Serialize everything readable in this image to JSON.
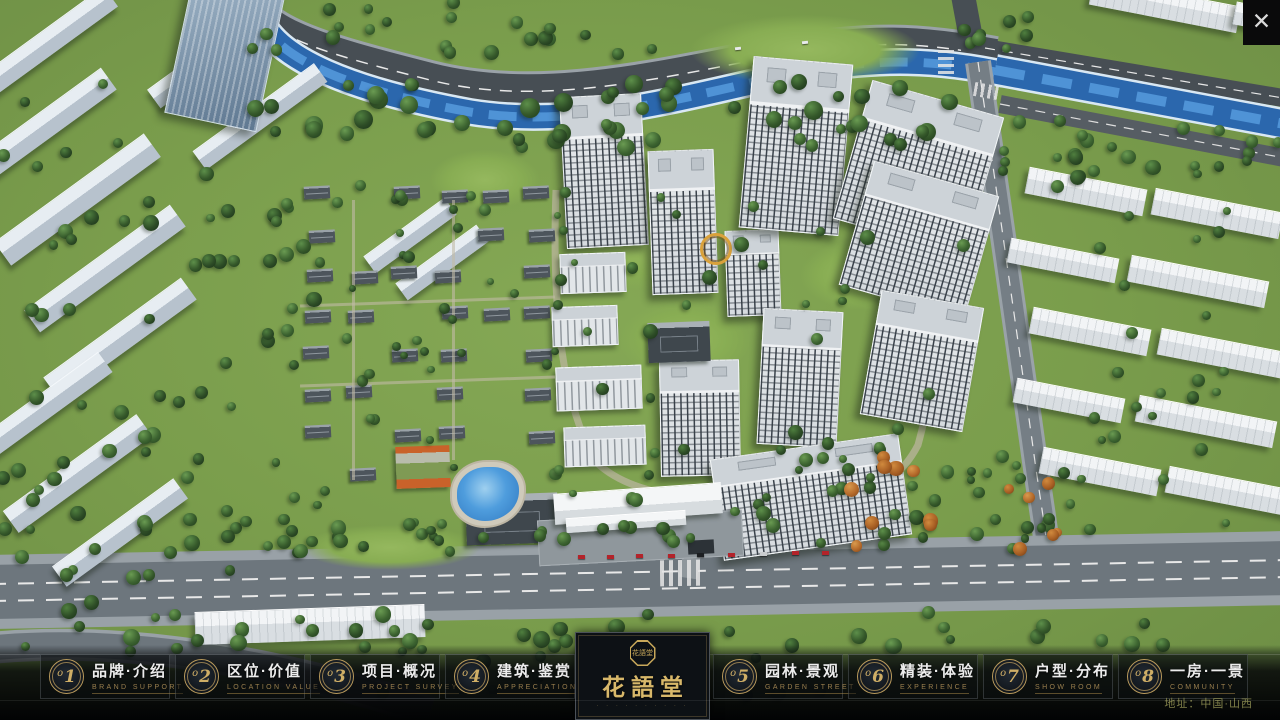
{
  "chrome": {
    "close_icon": "✕"
  },
  "menu": {
    "items": [
      {
        "badge": "o1",
        "zh": "品牌·介绍",
        "en": "BRAND SUPPORT"
      },
      {
        "badge": "o2",
        "zh": "区位·价值",
        "en": "LOCATION VALUE"
      },
      {
        "badge": "o3",
        "zh": "项目·概况",
        "en": "PROJECT SURVEY"
      },
      {
        "badge": "o4",
        "zh": "建筑·鉴赏",
        "en": "APPRECIATION"
      },
      {
        "badge": "o5",
        "zh": "园林·景观",
        "en": "GARDEN STREET"
      },
      {
        "badge": "o6",
        "zh": "精装·体验",
        "en": "EXPERIENCE"
      },
      {
        "badge": "o7",
        "zh": "户型·分布",
        "en": "SHOW ROOM"
      },
      {
        "badge": "o8",
        "zh": "一房·一景",
        "en": "COMMUNITY"
      }
    ]
  },
  "logo": {
    "name": "花語堂",
    "seal_text": "花語堂",
    "subtext": "· · · · · · · · · ·"
  },
  "footer": {
    "address": "地址：中国·山西"
  },
  "colors": {
    "gold": "#c8a85a",
    "badge_gold": "#b99a5c",
    "menu_text": "#ececec",
    "menu_caption": "#9a7f4e",
    "address_text": "#8f8f52",
    "bar_bg": "#060709",
    "river": "#2b67ad",
    "grass": "#7a9d4c"
  }
}
